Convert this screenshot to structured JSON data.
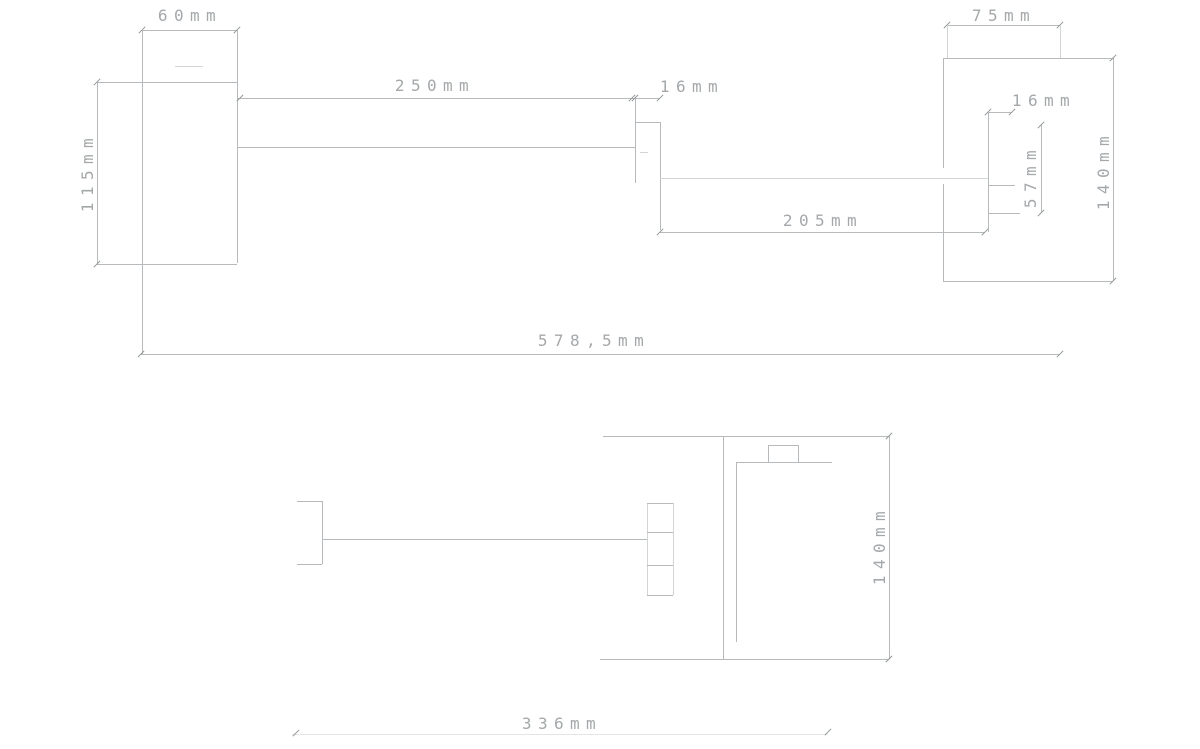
{
  "front_view": {
    "dims": {
      "plate_width": "60mm",
      "plate_height": "115mm",
      "arm_length": "250mm",
      "outlet_width": "16mm",
      "outlet_to_valve": "205mm",
      "total_width": "578,5mm"
    }
  },
  "side_view": {
    "dims": {
      "plate_width": "75mm",
      "spindle_width": "16mm",
      "spindle_length": "57mm",
      "plate_height": "140mm"
    }
  },
  "plan_view": {
    "dims": {
      "depth": "140mm",
      "span": "336mm"
    }
  },
  "colors": {
    "line": "#b6babc",
    "text": "#a4a8aa"
  }
}
